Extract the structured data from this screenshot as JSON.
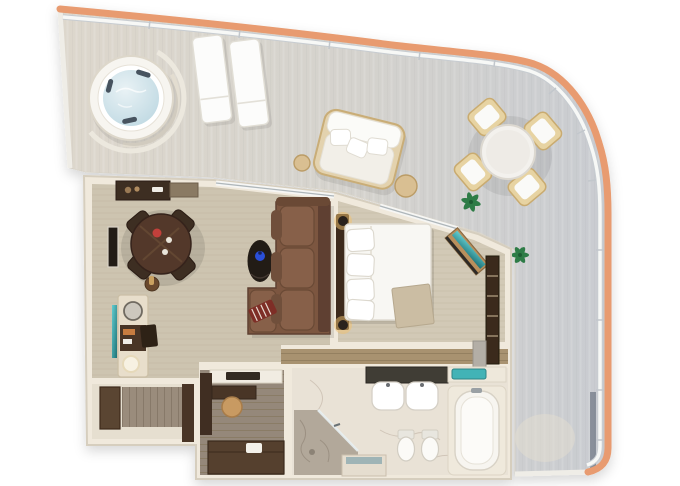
{
  "meta": {
    "title": "3D top-down floor plan of a suite with wrap-around balcony",
    "type": "floor-plan-render"
  },
  "palette": {
    "background": "#ffffff",
    "hull_band": "#e89b70",
    "railing": "#f7f8f6",
    "railing_post": "#c7ccd1",
    "deck_warm": "#ddd7cc",
    "deck_mid": "#d4d2cd",
    "deck_cool": "#c9ccd1",
    "deck_edge": "#efede7",
    "wall_fill": "#f0e9dc",
    "wall_edge": "#d6cebe",
    "carpet": "#cdc4b0",
    "carpet_bedroom": "#d2c9b6",
    "corridor_wood": "#a8926f",
    "dressing_floor": "#95887a",
    "entry_floor": "#e6dfd0",
    "entry_mat": "#9a8c7c",
    "marble_light": "#e9e2d6",
    "marble_dark": "#b2a89a",
    "walnut_dark": "#52392a",
    "cabinet_dark": "#3e2d20",
    "sofa_brown": "#7b5740",
    "sofa_shadow": "#5e4130",
    "cushion_brown": "#876049",
    "bed_linen": "#f8f7f3",
    "pillow_white": "#ffffff",
    "throw_beige": "#cbbda3",
    "headboard_wood": "#3d2c1f",
    "water_light": "#e9f2f5",
    "water_deep": "#bcd7e1",
    "tub_white": "#f7f5f0",
    "teal_accent": "#43b3b6",
    "plant_green": "#2f7b46",
    "stool_tan": "#c89a62",
    "flower_red": "#c2403a",
    "vase_blue": "#2b4fd8",
    "lamp_glow": "#f2c26d",
    "stripe_red": "#7e2f28"
  },
  "rooms": [
    {
      "id": "balcony",
      "label": "Wrap-around balcony terrace"
    },
    {
      "id": "living",
      "label": "Living room"
    },
    {
      "id": "bedroom",
      "label": "Bedroom"
    },
    {
      "id": "bathroom",
      "label": "Bathroom"
    },
    {
      "id": "shower",
      "label": "Walk-in shower"
    },
    {
      "id": "dressing",
      "label": "Dressing room"
    },
    {
      "id": "entry",
      "label": "Entry hall"
    }
  ],
  "furniture": {
    "balcony": [
      "whirlpool hot tub",
      "sun lounger x2",
      "outdoor daybed",
      "outdoor side table x2",
      "round outdoor dining table",
      "outdoor dining chair x4",
      "potted plant x2"
    ],
    "living": [
      "kitchenette counter",
      "wall tv",
      "round dining table",
      "dining chair x4",
      "wine holder",
      "minibar console",
      "console lamp",
      "console stool",
      "teal accent strip",
      "oval coffee table",
      "blue vase",
      "sectional sofa with chaise",
      "striped accent pillow"
    ],
    "bedroom": [
      "king bed",
      "headboard",
      "bed pillows",
      "beige throw",
      "bedside sconce x2",
      "teal-top dresser",
      "closet shelving",
      "closet drawers"
    ],
    "bathroom": [
      "double vanity",
      "sink x2",
      "teal towel tray",
      "toilet",
      "bidet",
      "bathtub",
      "marble shower",
      "shower glass door",
      "shower bench"
    ],
    "dressing": [
      "wall counter",
      "vanity desk",
      "vanity stool",
      "wardrobe",
      "low cabinet"
    ],
    "entry": [
      "entry door",
      "wood mat",
      "entry closet"
    ]
  }
}
